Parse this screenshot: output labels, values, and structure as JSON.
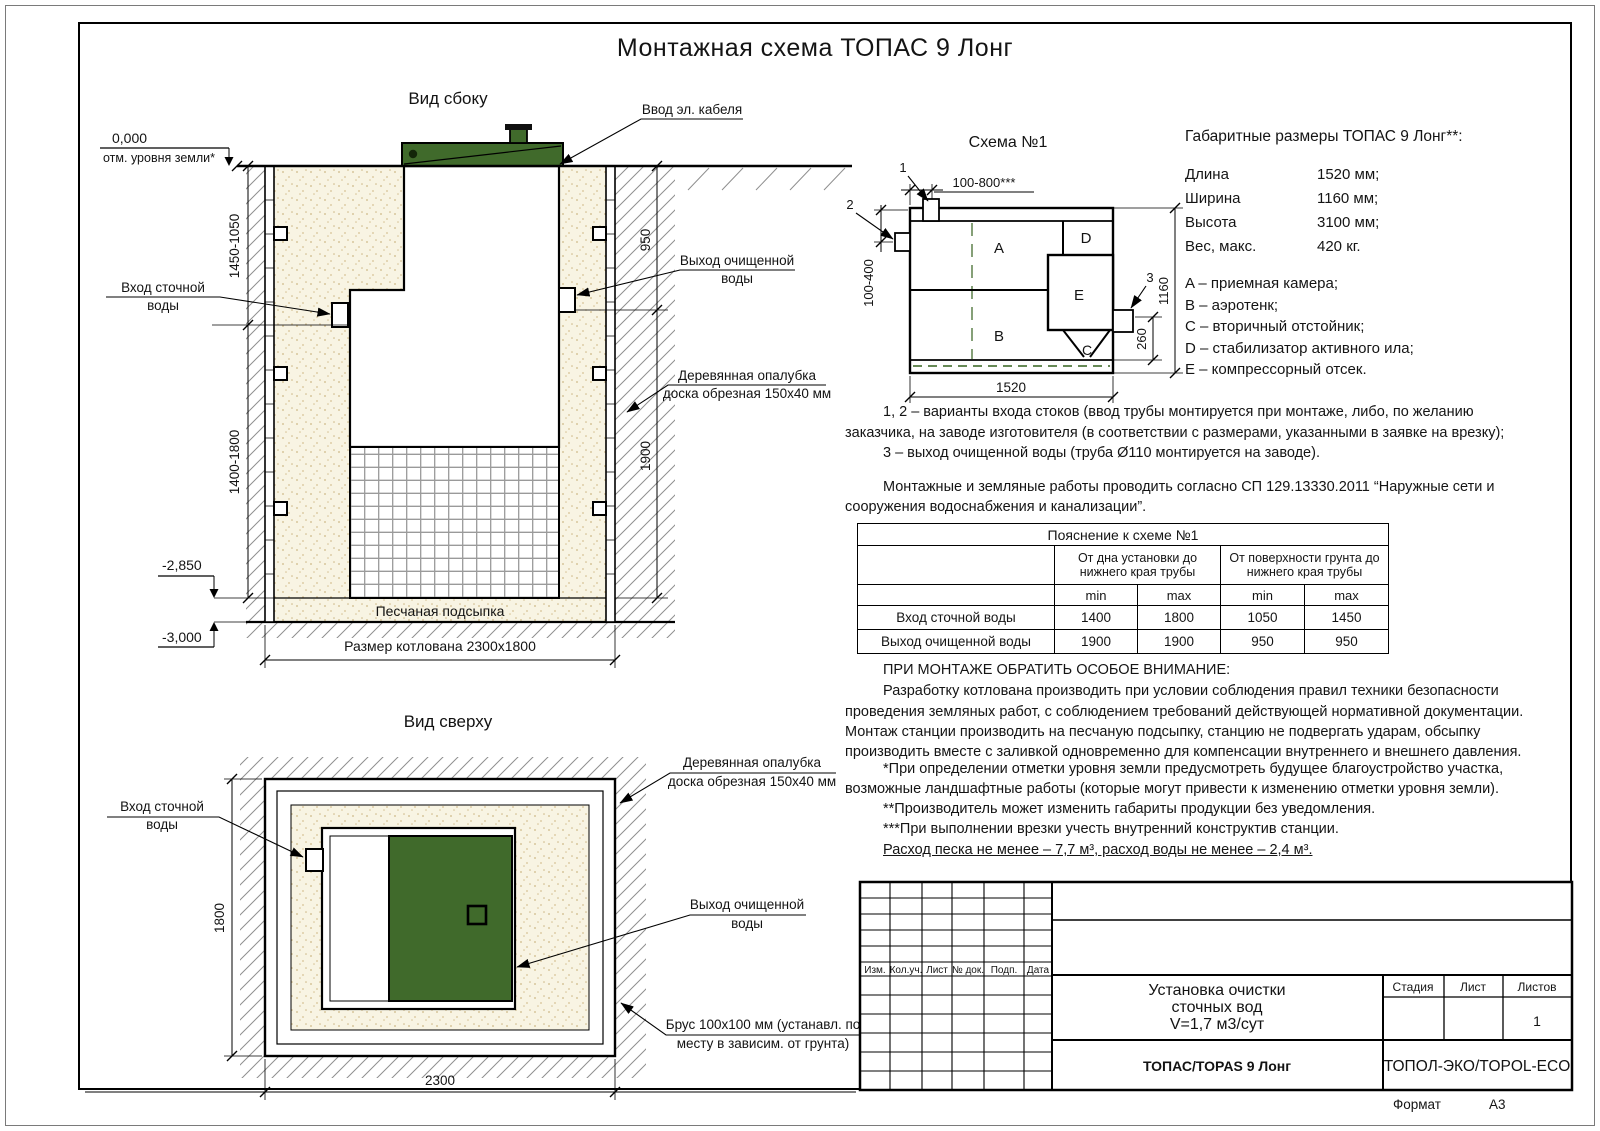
{
  "sheet": {
    "title": "Монтажная схема ТОПАС 9 Лонг",
    "format_label": "Формат",
    "format_value": "А3"
  },
  "colors": {
    "lid_green": "#406a2b",
    "sand_fill": "#f8f4e3"
  },
  "side_view": {
    "title": "Вид сбоку",
    "level_zero": "0,000",
    "level_zero_note": "отм. уровня земли*",
    "cable_label": "Ввод эл. кабеля",
    "inlet_line1": "Вход сточной",
    "inlet_line2": "воды",
    "outlet_line1": "Выход очищенной",
    "outlet_line2": "воды",
    "formwork_line1": "Деревянная опалубка",
    "formwork_line2": "доска обрезная 150х40 мм",
    "sand_label": "Песчаная подсыпка",
    "pit_size": "Размер котлована 2300х1800",
    "level_2850": "-2,850",
    "level_3000": "-3,000",
    "dim_left_top": "1450-1050",
    "dim_left_bottom": "1400-1800",
    "dim_right_top": "950",
    "dim_right_bottom": "1900"
  },
  "top_view": {
    "title": "Вид сверху",
    "inlet_line1": "Вход сточной",
    "inlet_line2": "воды",
    "formwork_line1": "Деревянная опалубка",
    "formwork_line2": "доска обрезная 150х40 мм",
    "outlet_line1": "Выход очищенной",
    "outlet_line2": "воды",
    "beam_line1": "Брус 100х100 мм (устанавл. по",
    "beam_line2": "месту в зависим. от грунта)",
    "dim_width": "1800",
    "dim_length": "2300"
  },
  "schema": {
    "title": "Схема №1",
    "zone_a": "A",
    "zone_b": "B",
    "zone_c": "C",
    "zone_d": "D",
    "zone_e": "E",
    "marker_1": "1",
    "marker_2": "2",
    "marker_3": "3",
    "dim_top": "100-800***",
    "dim_left": "100-400",
    "dim_right": "1160",
    "dim_outlet": "260",
    "dim_bottom": "1520"
  },
  "specs": {
    "title": "Габаритные размеры ТОПАС 9 Лонг**:",
    "rows": [
      {
        "label": "Длина",
        "value": "1520 мм;"
      },
      {
        "label": "Ширина",
        "value": "1160 мм;"
      },
      {
        "label": "Высота",
        "value": "3100 мм;"
      },
      {
        "label": "Вес, макс.",
        "value": "420 кг."
      }
    ],
    "legend": [
      "A – приемная камера;",
      "B – аэротенк;",
      "C – вторичный отстойник;",
      "D – стабилизатор активного ила;",
      "E – компрессорный отсек."
    ]
  },
  "notes": {
    "note1": "1, 2 – варианты входа стоков (ввод трубы монтируется при монтаже, либо, по желанию заказчика, на заводе изготовителя (в соответствии с размерами, указанными в заявке на врезку);",
    "note2": "3 – выход очищенной воды (труба Ø110 монтируется на заводе).",
    "note3": "Монтажные и земляные работы проводить согласно СП 129.13330.2011 “Наружные сети и сооружения водоснабжения и канализации”."
  },
  "table": {
    "title": "Пояснение к схеме №1",
    "col_group1": "От дна установки до нижнего края трубы",
    "col_group2": "От поверхности грунта до нижнего края трубы",
    "min_label": "min",
    "max_label": "max",
    "rows": [
      {
        "label": "Вход сточной воды",
        "v1": "1400",
        "v2": "1800",
        "v3": "1050",
        "v4": "1450"
      },
      {
        "label": "Выход очищенной воды",
        "v1": "1900",
        "v2": "1900",
        "v3": "950",
        "v4": "950"
      }
    ]
  },
  "attention": {
    "heading": "ПРИ МОНТАЖЕ ОБРАТИТЬ ОСОБОЕ ВНИМАНИЕ:",
    "body": "Разработку котлована производить при условии соблюдения правил техники безопасности проведения земляных работ, с соблюдением требований действующей нормативной документации. Монтаж станции производить на песчаную подсыпку, станцию не подвергать ударам, обсыпку производить вместе с заливкой одновременно для компенсации внутреннего и внешнего давления."
  },
  "footnotes": {
    "f1": "*При определении отметки уровня земли предусмотреть будущее благоустройство участка, возможные ландшафтные работы (которые могут привести к изменению отметки уровня земли).",
    "f2": "**Производитель может изменить габариты продукции без уведомления.",
    "f3": "***При выполнении врезки учесть внутренний конструктив станции.",
    "consumption": "Расход песка не менее – 7,7 м³, расход воды не менее – 2,4 м³."
  },
  "title_block": {
    "cols": [
      "Изм.",
      "Кол.уч.",
      "Лист",
      "№ док.",
      "Подп.",
      "Дата"
    ],
    "project_line1": "Установка очистки",
    "project_line2": "сточных вод",
    "project_line3": "V=1,7 м3/сут",
    "stage_label": "Стадия",
    "sheet_label": "Лист",
    "sheets_label": "Листов",
    "sheets_value": "1",
    "product": "ТОПАС/TOPAS 9 Лонг",
    "company": "ТОПОЛ-ЭКО/TOPOL-ECO"
  }
}
